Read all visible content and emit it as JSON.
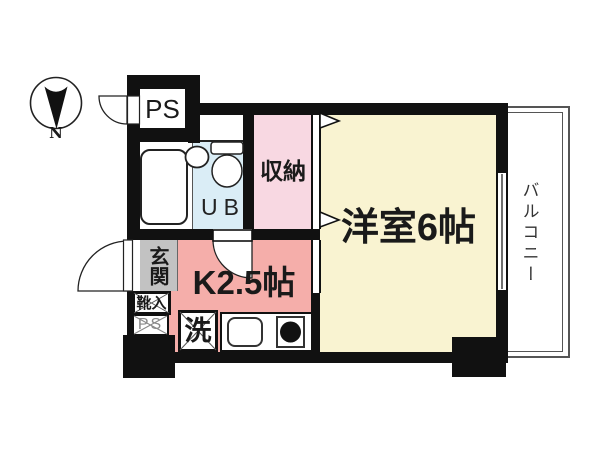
{
  "plan_type": "apartment-floorplan",
  "compass": {
    "north": "N"
  },
  "rooms": {
    "ps_top": "PS",
    "unit_bath": "UB",
    "storage": "収納",
    "western_room": "洋室6帖",
    "kitchen": "K2.5帖",
    "entrance": "玄関",
    "shoe_cabinet": "靴入",
    "pipe_space": "PS",
    "washer": "洗",
    "balcony": "バルコニー"
  },
  "colors": {
    "wall": "#111111",
    "western_room": "#f9f3d1",
    "storage_pink": "#f8d8e2",
    "kitchen_salmon": "#f5aeaa",
    "bath_blue": "#daedf6",
    "entrance_gray": "#c2c2c2",
    "balcony_line": "#555555"
  }
}
